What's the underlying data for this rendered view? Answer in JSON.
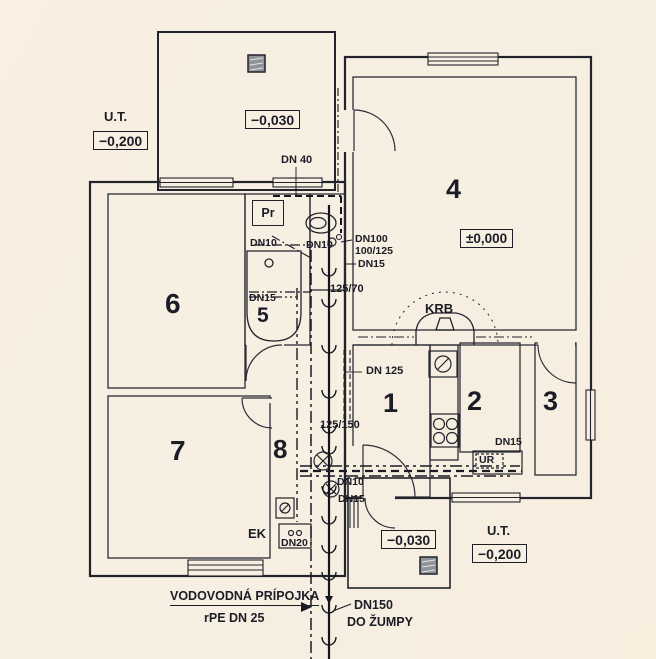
{
  "drawing_title": "house-plumbing-floor-plan",
  "rooms": [
    {
      "number": "1"
    },
    {
      "number": "2"
    },
    {
      "number": "3"
    },
    {
      "number": "4"
    },
    {
      "number": "5"
    },
    {
      "number": "6"
    },
    {
      "number": "7"
    },
    {
      "number": "8"
    }
  ],
  "levels": {
    "ut_top_label": "U.T.",
    "ut_top_value": "−0,200",
    "terrace_top_value": "−0,030",
    "main_floor_value": "±0,000",
    "terrace_bottom_value": "−0,030",
    "ut_bottom_label": "U.T.",
    "ut_bottom_value": "−0,200"
  },
  "pipe_labels": {
    "dn40": "DN 40",
    "dn10_washer": "DN10",
    "dn10_wc": "DN10",
    "dn100": "DN100",
    "s100_125": "100/125",
    "dn15_wc": "DN15",
    "s125_70": "125/70",
    "dn15_bath": "DN15",
    "dn125": "DN 125",
    "s125_150": "125/150",
    "dn15_boiler": "DN15",
    "dn10_hall": "DN10",
    "dn15_hall": "DN15",
    "dn20": "DN20",
    "dn150": "DN150",
    "dn150_destination": "DO ŽUMPY",
    "water_service_name": "VODOVODNÁ PRÍPOJKA",
    "water_service_spec": "rPE DN 25"
  },
  "fixtures": {
    "washer_label": "Pr",
    "boiler_label": "UR",
    "fireplace_label": "KRB",
    "ek_label": "EK"
  },
  "colors": {
    "paper": "#f6efe2",
    "ink": "#23232c"
  }
}
